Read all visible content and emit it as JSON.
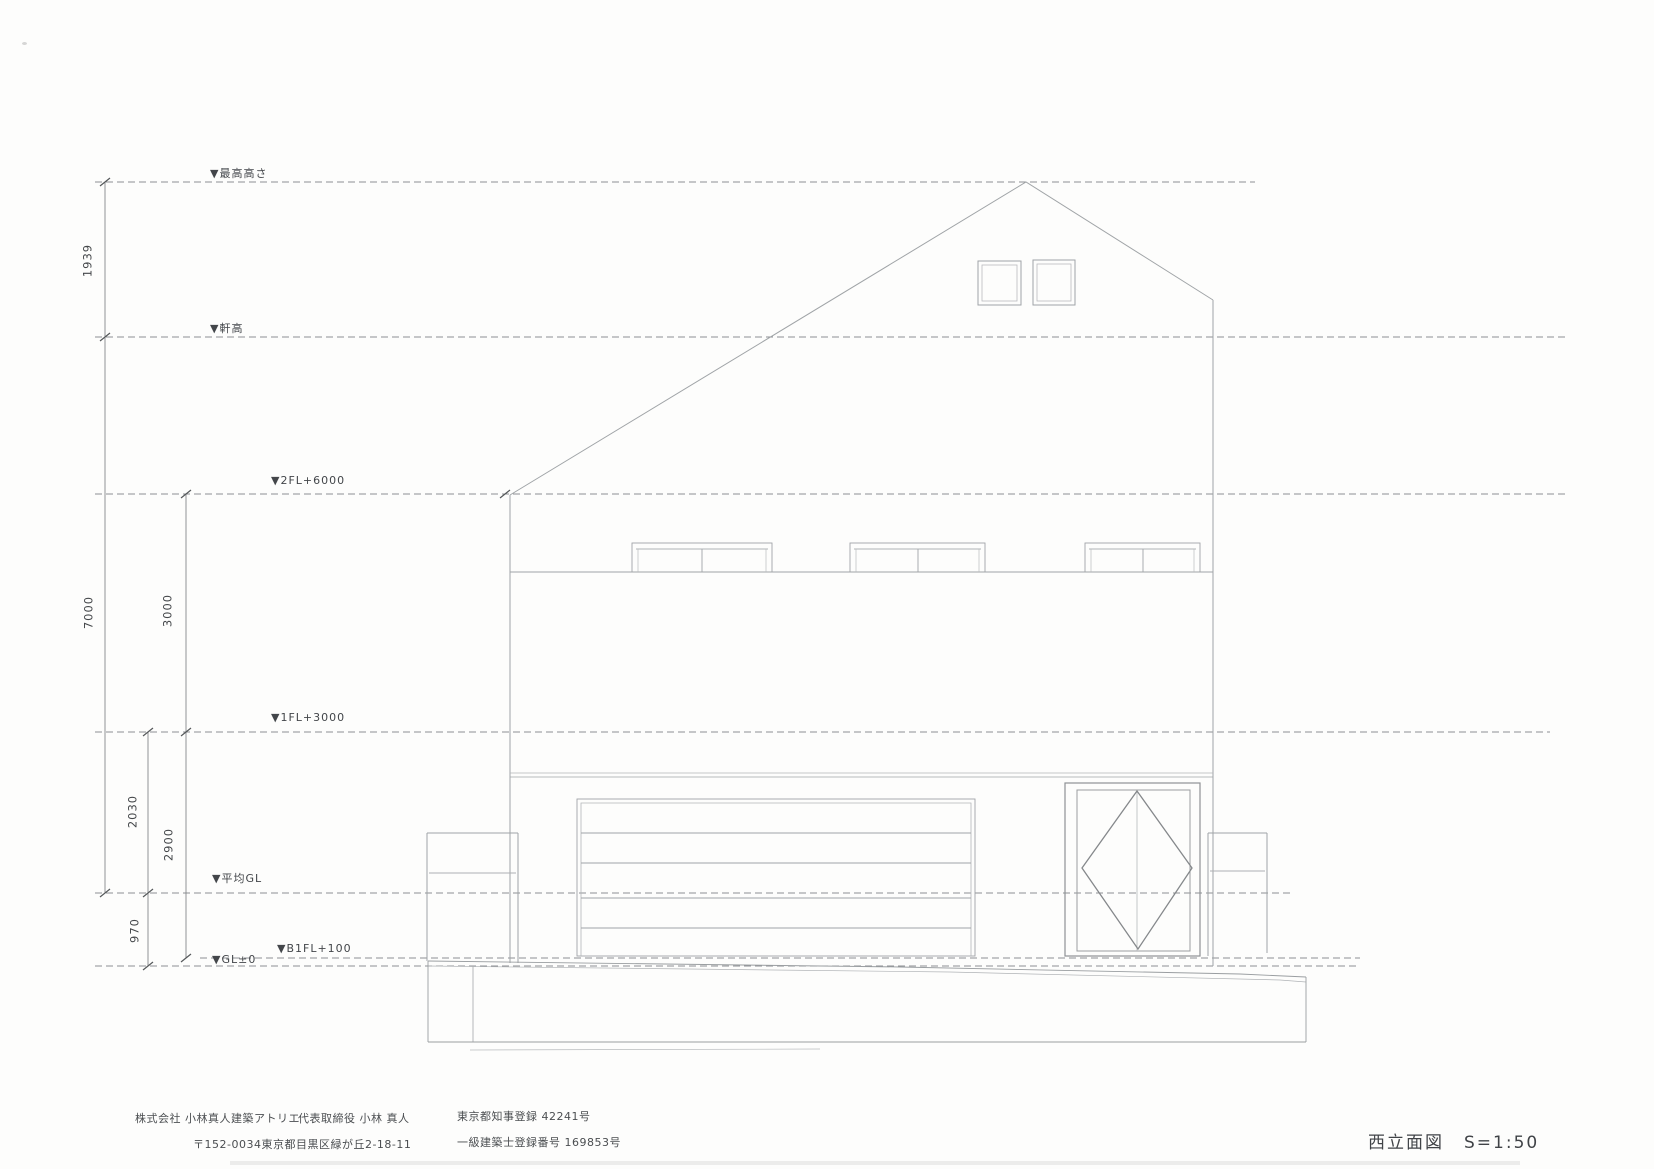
{
  "drawing": {
    "title": "西立面図",
    "scale": "S=1:50"
  },
  "levels": {
    "max_height": "▼最高高さ",
    "eave": "▼軒高",
    "fl2": "▼2FL+6000",
    "fl1": "▼1FL+3000",
    "avg_gl": "▼平均GL",
    "b1fl": "▼B1FL+100",
    "gl0": "▼GL±0"
  },
  "dimensions": {
    "d1939": "1939",
    "d7000": "7000",
    "d3000": "3000",
    "d2030": "2030",
    "d2900": "2900",
    "d970": "970"
  },
  "footer": {
    "company": "株式会社 小林真人建築アトリエ",
    "representative": "代表取締役 小林 真人",
    "license1": "東京都知事登録 42241号",
    "address": "〒152-0034東京都目黒区緑が丘2-18-11",
    "license2": "一級建築士登録番号 169853号"
  },
  "colors": {
    "building_line": "#a4a8ab",
    "dashed_level_line": "#8d9093",
    "dimension_line": "#85888b",
    "tick": "#55585a",
    "text": "#43464a",
    "background": "#fdfdfc"
  }
}
